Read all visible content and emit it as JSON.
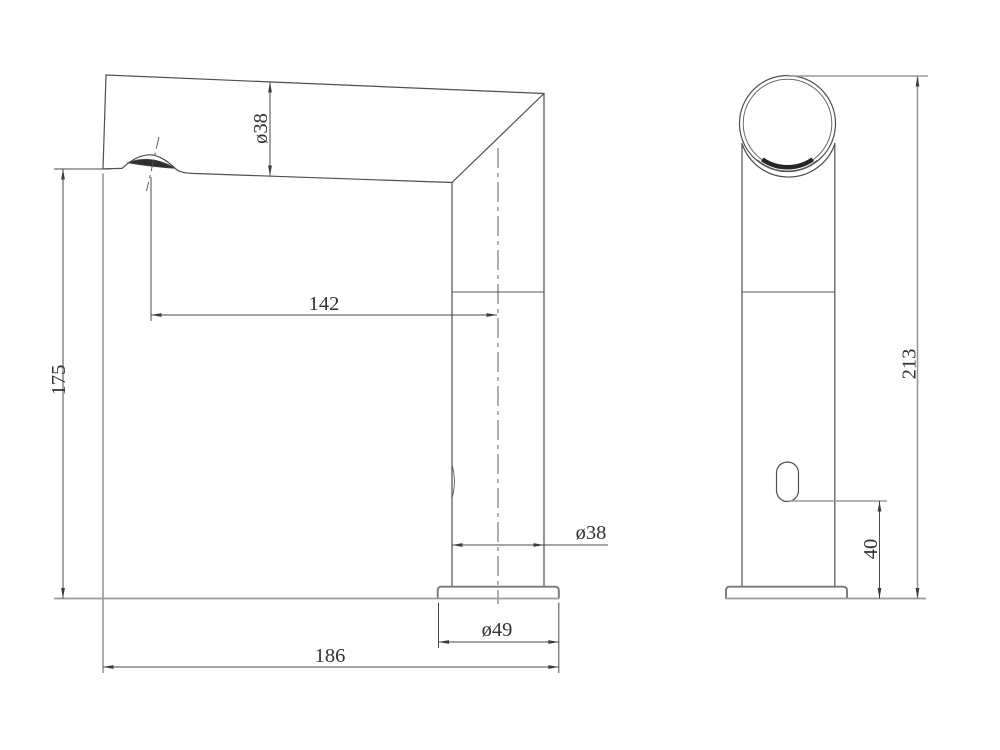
{
  "drawing": {
    "type": "technical-dimension-drawing",
    "subject": "sensor-faucet-two-views",
    "colors": {
      "background": "#ffffff",
      "object_line": "#4f4f4f",
      "light_line": "#9a9a9a",
      "text": "#333333",
      "dark_fill": "#2e2e2e"
    },
    "dimensions": {
      "spout_diameter": "ø38",
      "spout_reach": "142",
      "spout_outlet_height": "175",
      "body_diameter": "ø38",
      "base_diameter": "ø49",
      "overall_depth": "186",
      "overall_height": "213",
      "sensor_height": "40"
    }
  }
}
